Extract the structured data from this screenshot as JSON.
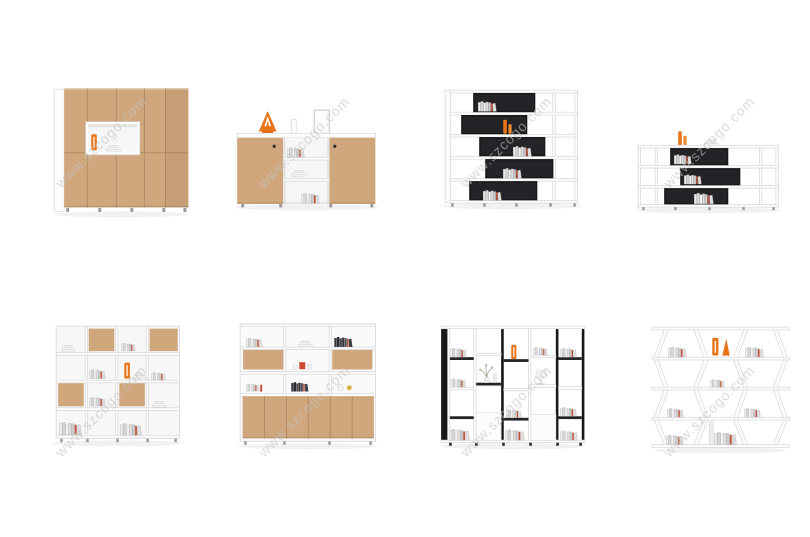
{
  "page": {
    "background": "#ffffff",
    "grid": {
      "rows": 2,
      "cols": 4
    }
  },
  "watermark": {
    "text": "www.szcogo.com",
    "angle_deg": -45
  },
  "colors": {
    "wood": "#d0a77c",
    "wood_shade": "#c2965f",
    "panel_black": "#18181a",
    "accent_orange": "#e8751a",
    "furniture_white": "#fbfbfb",
    "line_gray": "#d8d8d8",
    "watermark_gray": "#c3c3c3"
  },
  "products": [
    {
      "id": "wood-cabinet-tall",
      "label": "Tall wooden door cabinet with open display niche and orange vase"
    },
    {
      "id": "wood-sideboard",
      "label": "Low sideboard with two wooden doors, open middle shelves and orange ornament on top"
    },
    {
      "id": "staggered-shelf-5-tier",
      "label": "Five-tier white bookshelf with staggered black box compartments"
    },
    {
      "id": "staggered-shelf-3-tier",
      "label": "Three-tier low white shelf with staggered black box compartments and orange bottles"
    },
    {
      "id": "checkerboard-bookcase",
      "label": "White bookcase with checkerboard wooden door panels"
    },
    {
      "id": "bookcase-wood-base-doors",
      "label": "White bookcase with wooden flip panels and six wooden base doors"
    },
    {
      "id": "column-room-divider",
      "label": "Black and white vertical column room-divider shelf with plant and lamp"
    },
    {
      "id": "zigzag-shelf",
      "label": "White zig-zag open shelf with books and orange bookends"
    }
  ]
}
